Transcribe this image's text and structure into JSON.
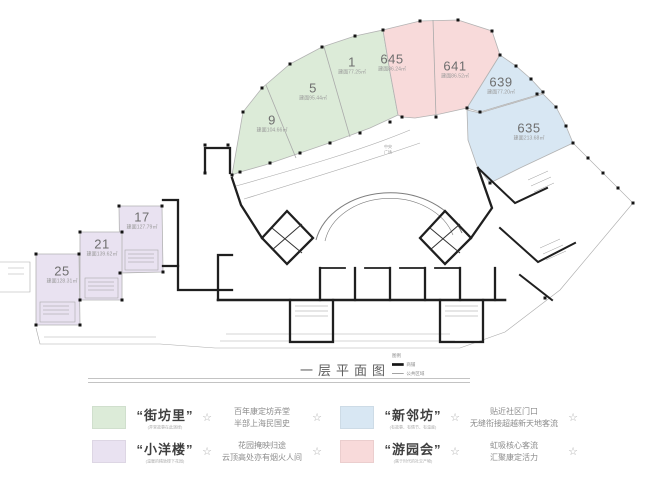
{
  "title": {
    "text": "一层平面图"
  },
  "mini_legend": {
    "note": "图例",
    "items": [
      {
        "label": "商铺"
      },
      {
        "label": "公共区域"
      }
    ]
  },
  "courtyard": {
    "line1": "中央",
    "line2": "广场"
  },
  "colors": {
    "green": "#dcebd8",
    "pink": "#f8dada",
    "blue": "#d8e7f3",
    "purple": "#e9e2f1",
    "wall": "#1f1f1f"
  },
  "units": [
    {
      "num": "9",
      "area": "建面104.66㎡"
    },
    {
      "num": "5",
      "area": "建面95.44㎡"
    },
    {
      "num": "1",
      "area": "建面77.25㎡"
    },
    {
      "num": "645",
      "area": "建面86.24㎡"
    },
    {
      "num": "641",
      "area": "建面86.52㎡"
    },
    {
      "num": "639",
      "area": "建面77.20㎡"
    },
    {
      "num": "635",
      "area": "建面213.68㎡"
    },
    {
      "num": "17",
      "area": "建面127.79㎡"
    },
    {
      "num": "21",
      "area": "建面139.62㎡"
    },
    {
      "num": "25",
      "area": "建面128.31㎡"
    }
  ],
  "icons": {
    "star": "☆"
  },
  "legend": {
    "items": [
      {
        "title": "“街坊里”",
        "subtitle": "(弄堂故事在此演绎)",
        "desc1": "百年康定坊弄堂",
        "desc2": "半部上海民国史",
        "color": "#dcebd8"
      },
      {
        "title": "“小洋楼”",
        "subtitle": "(温暖的精致楼下花园)",
        "desc1": "花园掩映归途",
        "desc2": "云顶高处亦有烟火人间",
        "color": "#e9e2f1"
      },
      {
        "title": "“新邻坊”",
        "subtitle": "(有故事、有情节、有温度)",
        "desc1": "贴近社区门口",
        "desc2": "无缝衔接超越新天地客流",
        "color": "#d8e7f3"
      },
      {
        "title": "“游园会”",
        "subtitle": "(属于时代的社交产物)",
        "desc1": "虹吸核心客流",
        "desc2": "汇聚康定活力",
        "color": "#f8dada"
      }
    ]
  }
}
